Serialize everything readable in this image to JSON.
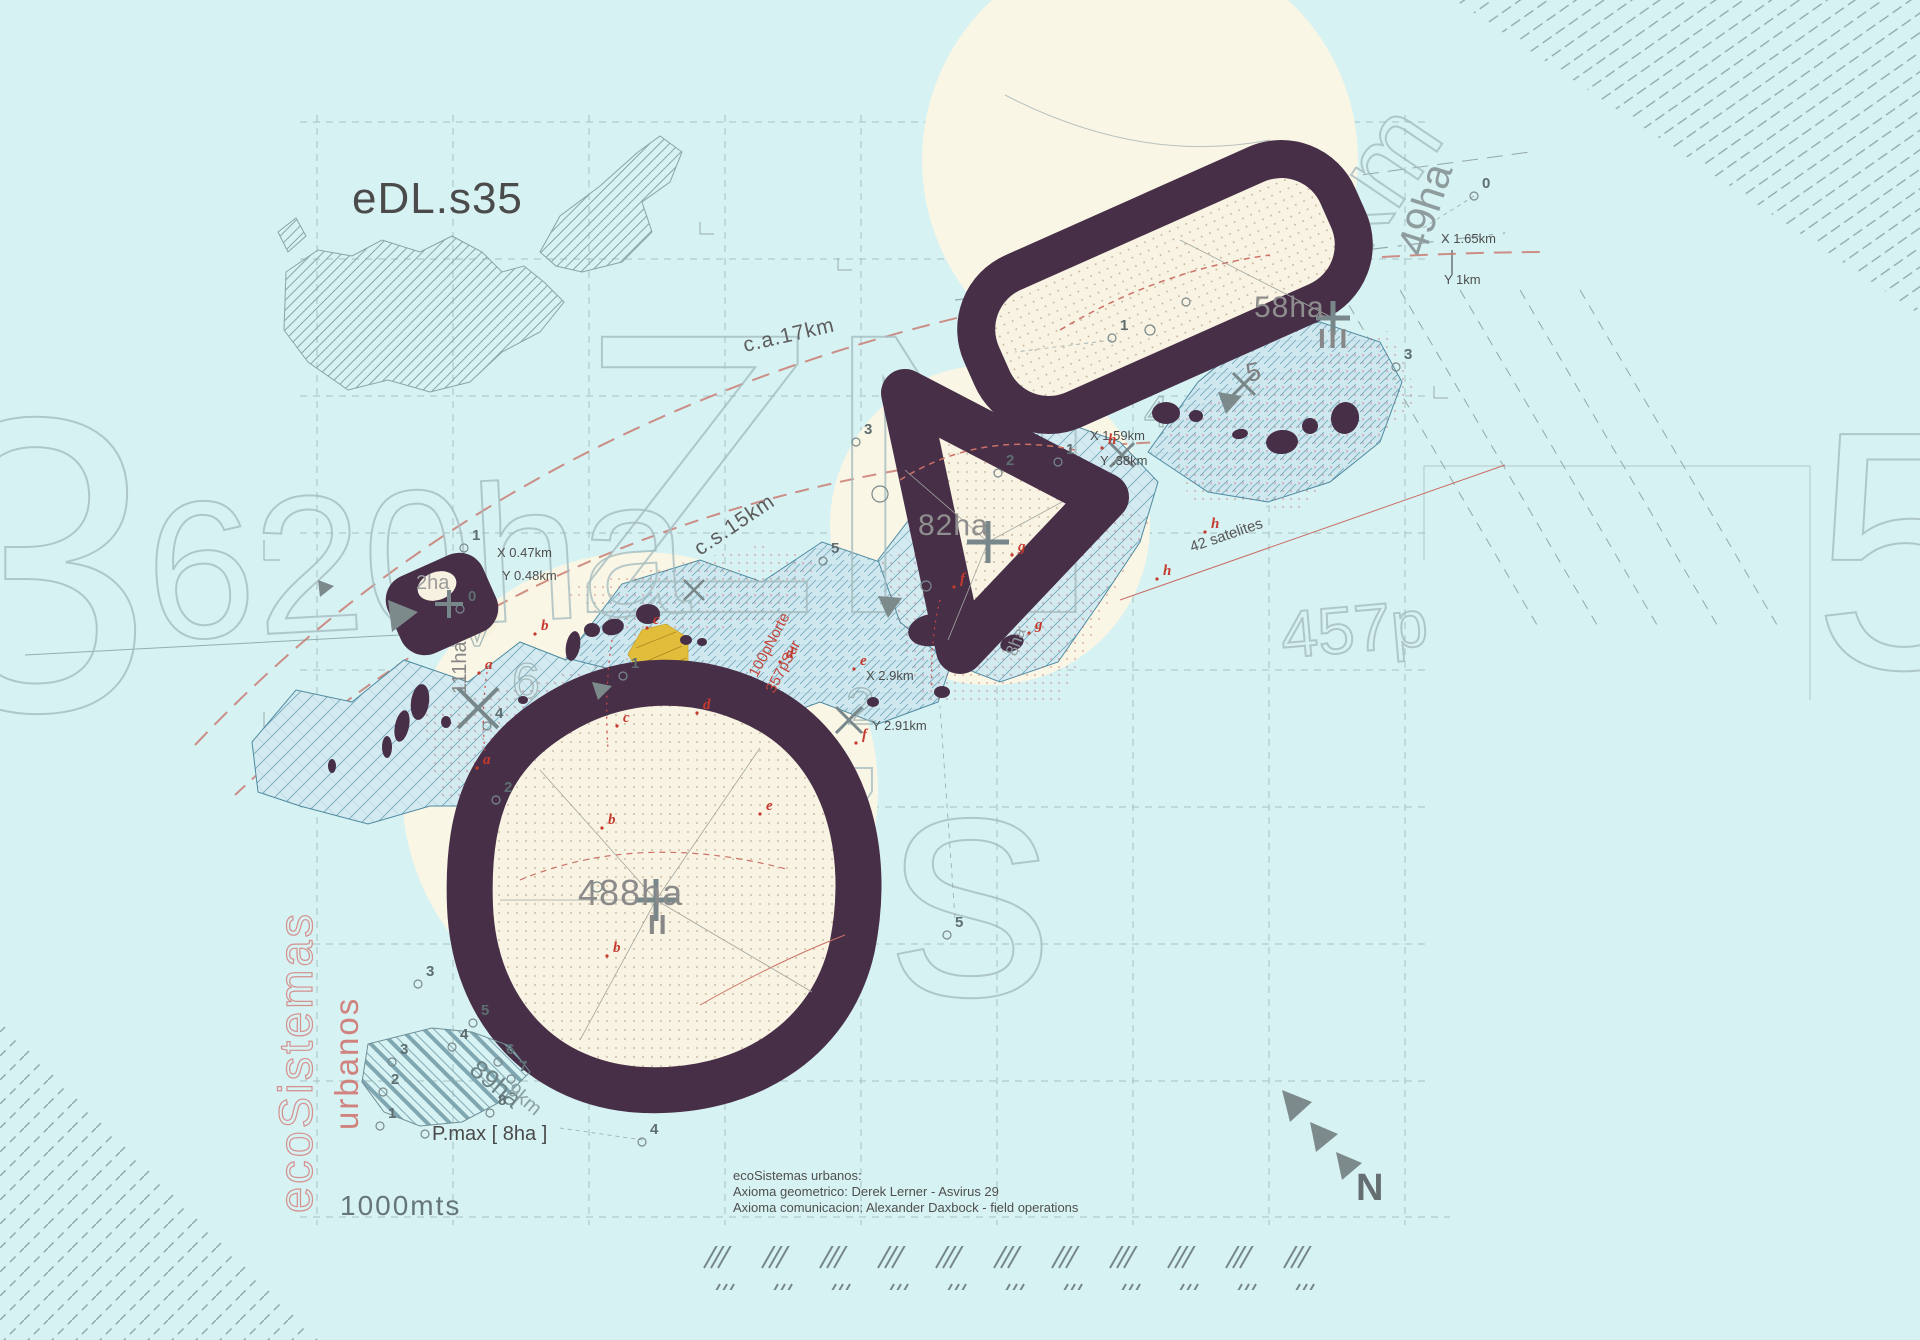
{
  "title": "eDL.s35",
  "colors": {
    "background": "#d7f2f3",
    "zone_ring_purple": "#472f47",
    "cream": "#f8f3e2",
    "band_teal": "#6ea6ba",
    "accent_red": "#c63a2e",
    "pink": "#d4908d",
    "yellow": "#e2bd3c",
    "ghost_grey": "#a6bdc0"
  },
  "labels": {
    "title": "eDL.s35",
    "zone58": "58ha",
    "roman58": "III",
    "zone82": "82ha",
    "zone488": "488ha",
    "roman488": "II",
    "zone2": "2ha",
    "zone89": "89ha",
    "zone89_km": "9km",
    "zone111": "111ha",
    "zone8": "8ha",
    "ghost49": "49ha",
    "curve_a": "c.a.17km",
    "curve_b": "c.s.15km",
    "satellites": "42 satelites",
    "norte": "100pNorte",
    "sur": "357pSur",
    "pmax": "P.max [ 8ha ]",
    "scale": "1000mts",
    "compass": "N",
    "eco_vertical": "ecoSistemas",
    "urban_vertical": "urbanos",
    "grey5": "5",
    "greyX": "x"
  },
  "credits": {
    "line1": "ecoSistemas urbanos:",
    "line2": "Axioma geometrico: Derek Lerner - Asvirus 29",
    "line3": "Axioma comunicacion: Alexander Daxbock - field operations"
  },
  "coordinates": [
    {
      "text": "X 0.47km",
      "x": 497,
      "y": 557
    },
    {
      "text": "Y 0.48km",
      "x": 502,
      "y": 580
    },
    {
      "text": "X 1.65km",
      "x": 1441,
      "y": 243
    },
    {
      "text": "Y 1km",
      "x": 1444,
      "y": 284
    },
    {
      "text": "X 1.59km",
      "x": 1090,
      "y": 440
    },
    {
      "text": "Y .38km",
      "x": 1100,
      "y": 465
    },
    {
      "text": "X 2.9km",
      "x": 866,
      "y": 680
    },
    {
      "text": "Y 2.91km",
      "x": 872,
      "y": 730
    }
  ],
  "ghost_texts": [
    {
      "text": "ZN",
      "x": 575,
      "y": 612,
      "size": 400,
      "rot": 0
    },
    {
      "text": "620ha",
      "x": 150,
      "y": 640,
      "size": 195,
      "rot": -3
    },
    {
      "text": "3",
      "x": -80,
      "y": 710,
      "size": 420,
      "rot": 0
    },
    {
      "text": "7s",
      "x": 705,
      "y": 995,
      "size": 330,
      "rot": 0
    },
    {
      "text": "457p",
      "x": 1283,
      "y": 658,
      "size": 66,
      "rot": -5
    },
    {
      "text": "0km",
      "x": 1330,
      "y": 310,
      "size": 110,
      "rot": -56
    },
    {
      "text": "5",
      "x": 1812,
      "y": 668,
      "size": 340,
      "rot": 0
    },
    {
      "text": "6",
      "x": 512,
      "y": 698,
      "size": 50,
      "rot": 0
    },
    {
      "text": "0",
      "x": 750,
      "y": 765,
      "size": 46,
      "rot": 0
    },
    {
      "text": "2",
      "x": 846,
      "y": 724,
      "size": 52,
      "rot": 0
    },
    {
      "text": "4",
      "x": 1144,
      "y": 427,
      "size": 44,
      "rot": 0
    },
    {
      "text": "IV",
      "x": 444,
      "y": 646,
      "size": 54,
      "rot": 0
    }
  ],
  "point_markers": [
    {
      "label": "1",
      "x": 1120,
      "y": 330
    },
    {
      "label": "0",
      "x": 1482,
      "y": 188
    },
    {
      "label": "3",
      "x": 864,
      "y": 434
    },
    {
      "label": "1",
      "x": 1066,
      "y": 454
    },
    {
      "label": "2",
      "x": 1006,
      "y": 465
    },
    {
      "label": "3",
      "x": 1404,
      "y": 359
    },
    {
      "label": "1",
      "x": 472,
      "y": 540
    },
    {
      "label": "5",
      "x": 955,
      "y": 927
    },
    {
      "label": "4",
      "x": 650,
      "y": 1134
    },
    {
      "label": "3",
      "x": 426,
      "y": 976
    },
    {
      "label": "2",
      "x": 504,
      "y": 792
    },
    {
      "label": "4",
      "x": 495,
      "y": 718
    },
    {
      "label": "1",
      "x": 631,
      "y": 668
    },
    {
      "label": "5",
      "x": 831,
      "y": 553
    },
    {
      "label": "0",
      "x": 468,
      "y": 601
    },
    {
      "label": "4",
      "x": 460,
      "y": 1039
    },
    {
      "label": "3",
      "x": 400,
      "y": 1054
    },
    {
      "label": "2",
      "x": 391,
      "y": 1084
    },
    {
      "label": "1",
      "x": 388,
      "y": 1118
    },
    {
      "label": "6",
      "x": 506,
      "y": 1054
    },
    {
      "label": "7",
      "x": 519,
      "y": 1071
    },
    {
      "label": "8",
      "x": 498,
      "y": 1105
    },
    {
      "label": "5",
      "x": 481,
      "y": 1015
    }
  ],
  "red_letters": [
    {
      "label": "a",
      "x": 485,
      "y": 669
    },
    {
      "label": "a",
      "x": 483,
      "y": 764
    },
    {
      "label": "b",
      "x": 541,
      "y": 630
    },
    {
      "label": "b",
      "x": 608,
      "y": 824
    },
    {
      "label": "b",
      "x": 613,
      "y": 952
    },
    {
      "label": "c",
      "x": 653,
      "y": 624
    },
    {
      "label": "c",
      "x": 623,
      "y": 722
    },
    {
      "label": "d",
      "x": 786,
      "y": 658
    },
    {
      "label": "d",
      "x": 703,
      "y": 709
    },
    {
      "label": "e",
      "x": 860,
      "y": 665
    },
    {
      "label": "e",
      "x": 766,
      "y": 810
    },
    {
      "label": "f",
      "x": 862,
      "y": 739
    },
    {
      "label": "f",
      "x": 960,
      "y": 583
    },
    {
      "label": "g",
      "x": 1018,
      "y": 551
    },
    {
      "label": "g",
      "x": 1035,
      "y": 629
    },
    {
      "label": "h",
      "x": 1108,
      "y": 444
    },
    {
      "label": "h",
      "x": 1163,
      "y": 575
    },
    {
      "label": "h",
      "x": 1211,
      "y": 528
    }
  ]
}
